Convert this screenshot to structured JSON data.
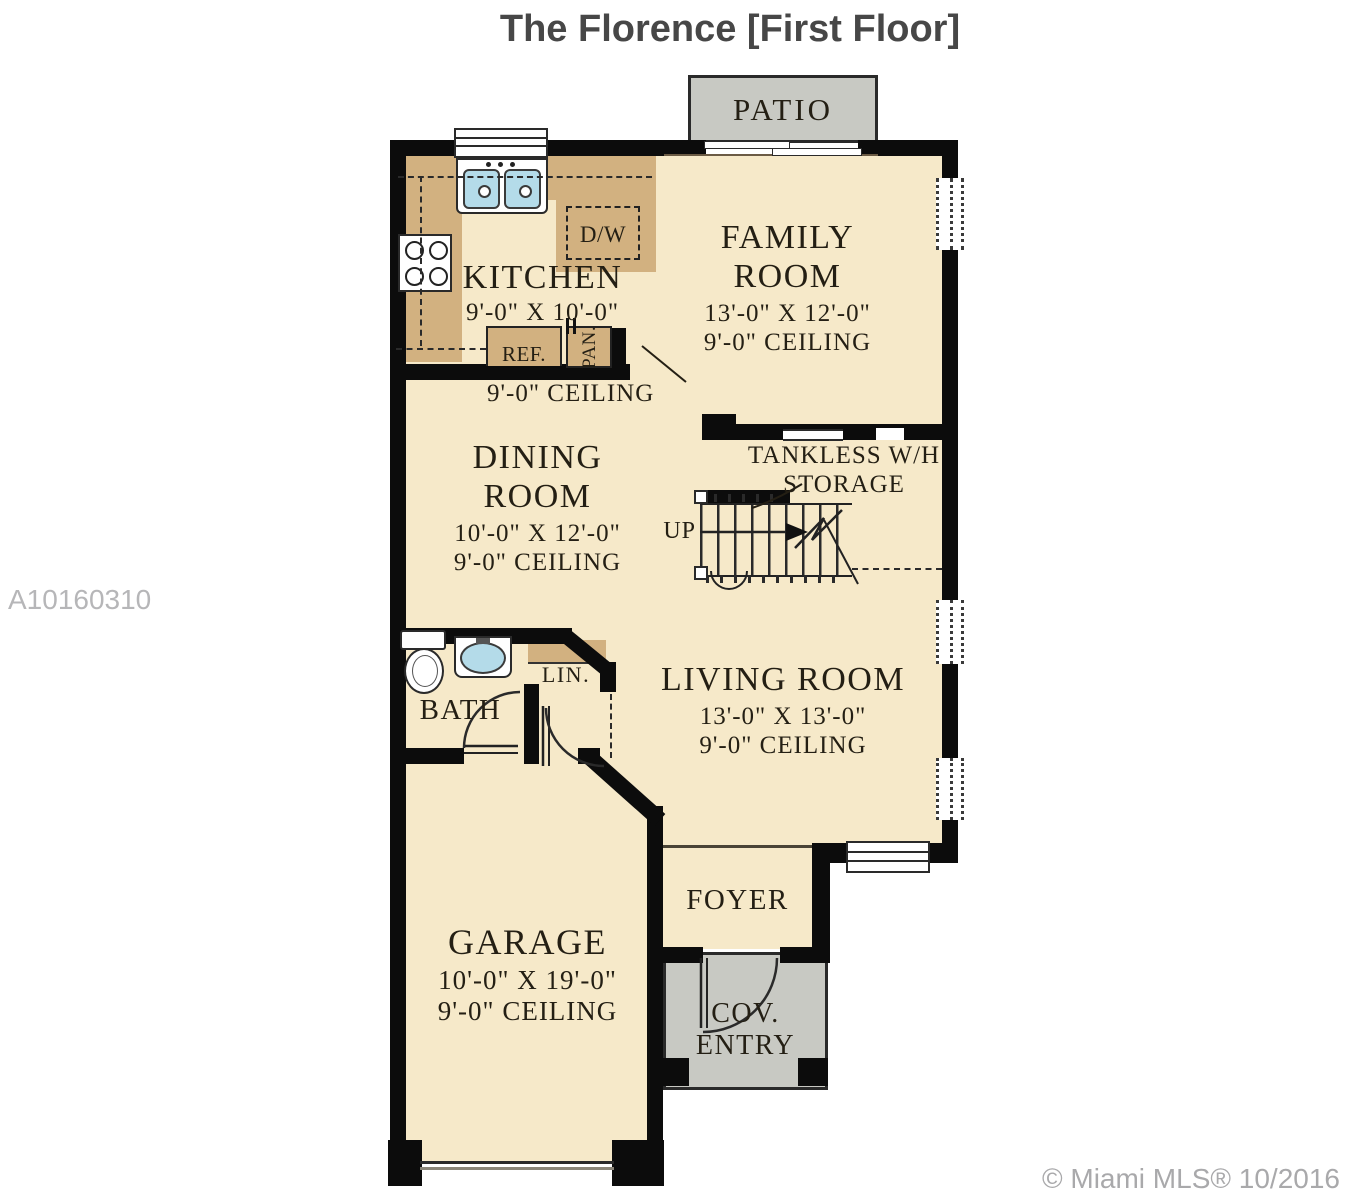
{
  "header": {
    "title": "The Florence [First Floor]"
  },
  "watermark": {
    "text": "A10160310"
  },
  "credit": {
    "text": "© Miami MLS® 10/2016"
  },
  "rooms": {
    "patio": {
      "name": "PATIO"
    },
    "family_room": {
      "line1": "FAMILY",
      "line2": "ROOM",
      "dims": "13'-0\" X 12'-0\"",
      "ceiling": "9'-0\" CEILING"
    },
    "kitchen": {
      "name": "KITCHEN",
      "dims": "9'-0\" X 10'-0\"",
      "ceiling": "9'-0\" CEILING"
    },
    "dining_room": {
      "line1": "DINING",
      "line2": "ROOM",
      "dims": "10'-0\" X 12'-0\"",
      "ceiling": "9'-0\" CEILING"
    },
    "storage": {
      "line1": "TANKLESS W/H",
      "line2": "STORAGE"
    },
    "stairs": {
      "label": "UP"
    },
    "bath": {
      "name": "BATH"
    },
    "linen": {
      "name": "LIN."
    },
    "living_room": {
      "name": "LIVING ROOM",
      "dims": "13'-0\" X 13'-0\"",
      "ceiling": "9'-0\" CEILING"
    },
    "garage": {
      "name": "GARAGE",
      "dims": "10'-0\" X 19'-0\"",
      "ceiling": "9'-0\" CEILING"
    },
    "foyer": {
      "name": "FOYER"
    },
    "covered_entry": {
      "line1": "COV.",
      "line2": "ENTRY"
    }
  },
  "fixtures": {
    "dishwasher": "D/W",
    "refrigerator": "REF.",
    "pantry": "PAN."
  },
  "colors": {
    "floor": "#f6e9c9",
    "counter": "#d2b180",
    "wall": "#0c0c0c",
    "patio_gray": "#c8c9c3",
    "sink_blue": "#b4dbe9",
    "title_text": "#474747",
    "label_text": "#241f14",
    "watermark_text": "#b6b6b8",
    "credit_text": "#a9a9ab"
  }
}
